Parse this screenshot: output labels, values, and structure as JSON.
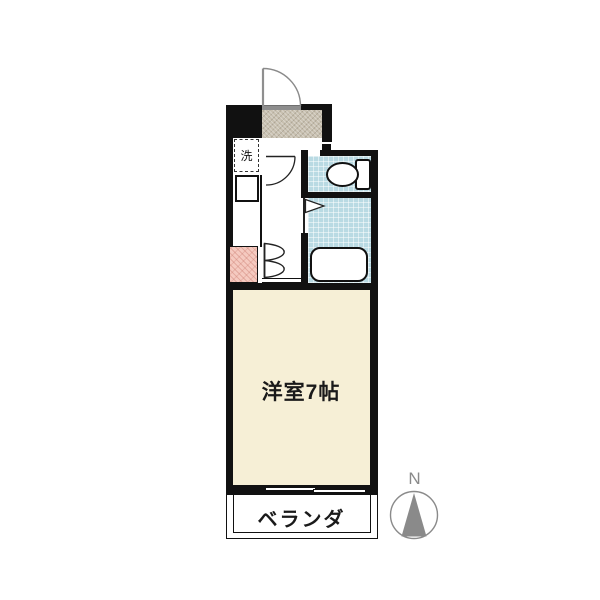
{
  "floorplan": {
    "rooms": {
      "main_room_label": "洋室7帖",
      "balcony_label": "ベランダ",
      "washer_label": "洗"
    },
    "compass": {
      "north_label": "N"
    },
    "colors": {
      "wall": "#111111",
      "room_fill": "#f6efd6",
      "wet_fill": "#b9dae3",
      "genkan_fill": "#c8c0b0",
      "stove_fill": "#f5cac0",
      "threshold_gray": "#8d8d8d",
      "compass_gray": "#8a8a8a"
    }
  }
}
